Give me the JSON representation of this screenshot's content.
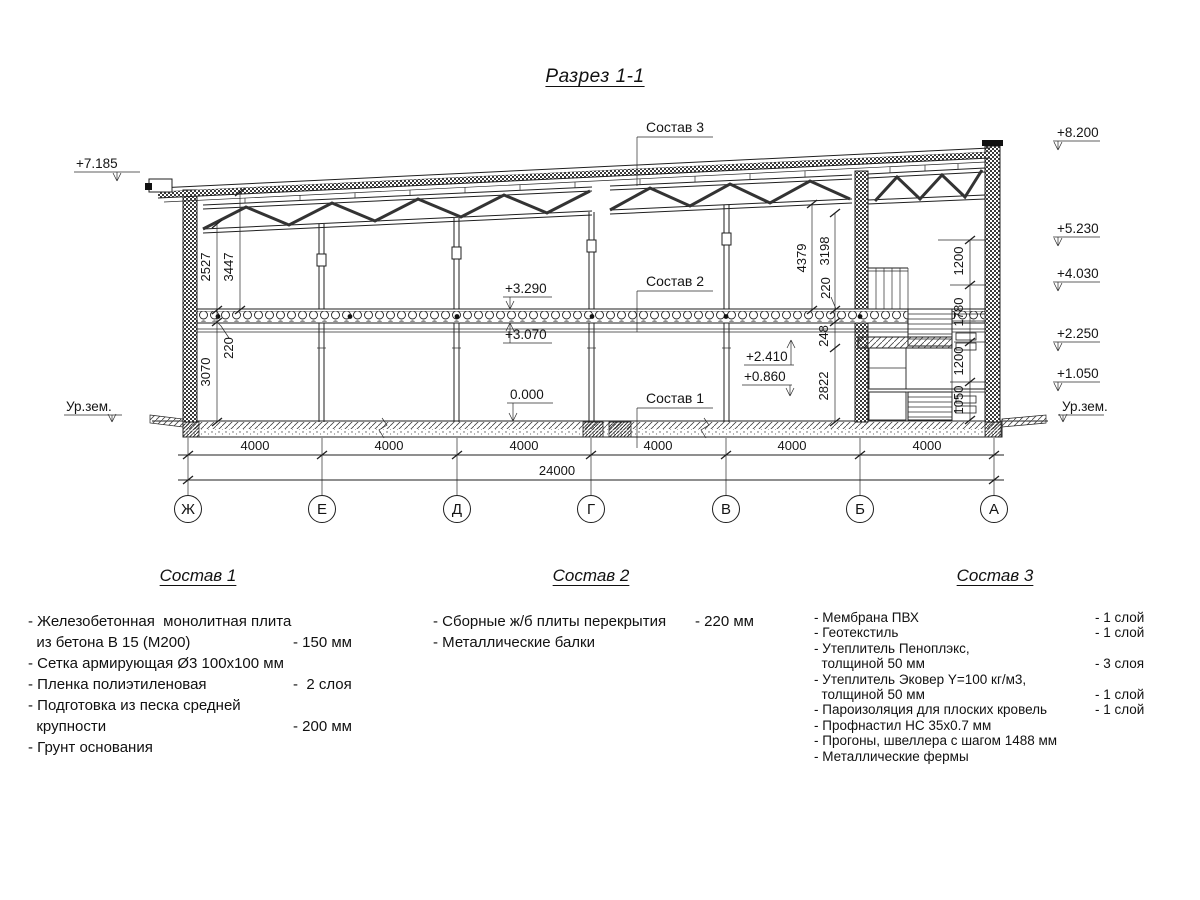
{
  "title": "Разрез 1-1",
  "section": {
    "leaders": {
      "sostav1": "Состав 1",
      "sostav2": "Состав 2",
      "sostav3": "Состав 3"
    },
    "levels": {
      "left_top": "+7.185",
      "ground_left": "Ур.зем.",
      "ground_right": "Ур.зем.",
      "right_1": "+8.200",
      "right_2": "+5.230",
      "right_3": "+4.030",
      "right_4": "+2.250",
      "right_5": "+1.050",
      "slab_top": "+3.290",
      "slab_bottom": "+3.070",
      "floor": "0.000",
      "stair_up": "+2.410",
      "stair_down": "+0.860"
    },
    "dims": {
      "d2527": "2527",
      "d3447": "3447",
      "slab_l": "220",
      "d3070": "3070",
      "d4379": "4379",
      "d3198": "3198",
      "slab_r": "220",
      "d248": "248",
      "d2822": "2822",
      "w1200a": "1200",
      "w1780": "1780",
      "w1200b": "1200",
      "w1050": "1050",
      "bays": [
        "4000",
        "4000",
        "4000",
        "4000",
        "4000",
        "4000"
      ],
      "total": "24000"
    },
    "axes": [
      "Ж",
      "Е",
      "Д",
      "Г",
      "В",
      "Б",
      "А"
    ]
  },
  "legends": [
    {
      "title": "Состав 1",
      "items": [
        {
          "text": "- Железобетонная  монолитная плита",
          "value": ""
        },
        {
          "text": "  из бетона В 15 (М200)",
          "value": "- 150 мм"
        },
        {
          "text": "- Сетка армирующая Ø3 100x100 мм",
          "value": ""
        },
        {
          "text": "- Пленка полиэтиленовая",
          "value": "-  2 слоя"
        },
        {
          "text": "- Подготовка из песка средней",
          "value": ""
        },
        {
          "text": "  крупности",
          "value": "- 200 мм"
        },
        {
          "text": "- Грунт основания",
          "value": ""
        }
      ]
    },
    {
      "title": "Состав 2",
      "items": [
        {
          "text": "- Сборные ж/б плиты перекрытия",
          "value": "- 220 мм"
        },
        {
          "text": "- Металлические балки",
          "value": ""
        }
      ]
    },
    {
      "title": "Состав 3",
      "items": [
        {
          "text": "- Мембрана ПВХ",
          "value": "- 1 слой"
        },
        {
          "text": "- Геотекстиль",
          "value": "- 1 слой"
        },
        {
          "text": "- Утеплитель Пеноплэкс,",
          "value": ""
        },
        {
          "text": "  толщиной 50 мм",
          "value": "- 3 слоя"
        },
        {
          "text": "- Утеплитель Эковер Y=100 кг/м3,",
          "value": ""
        },
        {
          "text": "  толщиной 50 мм",
          "value": "- 1 слой"
        },
        {
          "text": "- Пароизоляция для плоских кровель",
          "value": "- 1 слой"
        },
        {
          "text": "- Профнастил НС 35x0.7 мм",
          "value": ""
        },
        {
          "text": "- Прогоны, швеллера с шагом 1488 мм",
          "value": ""
        },
        {
          "text": "- Металлические фермы",
          "value": ""
        }
      ]
    }
  ]
}
